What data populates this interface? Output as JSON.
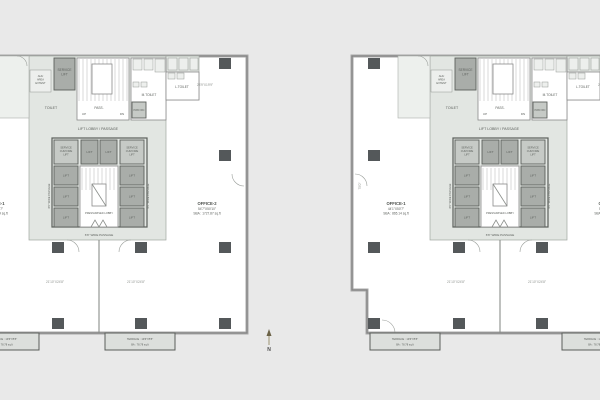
{
  "colors": {
    "background": "#e9e9e9",
    "plan_interior": "#ffffff",
    "core_fill": "#e2e6e2",
    "lift_fill": "#a9ada9",
    "column_fill": "#54585a",
    "terrace_fill": "#dcdfdc"
  },
  "labels": {
    "service_lift_l1": "SERVICE",
    "service_lift_l2": "LIFT",
    "ahu_l1": "AHU",
    "ahu_l2": "AREA",
    "ahu_l3": "EXTENT",
    "toilet": "TOILET",
    "pass": "PASS.",
    "up": "UP",
    "dn": "DN",
    "m_toilet": "M.TOILET",
    "l_toilet": "L.TOILET",
    "pwd": "PWD WC",
    "lift_lobby": "LIFT LOBBY / PASSAGE",
    "lift": "LIFT",
    "sfl_l1": "SERVICE",
    "sfl_l2": "CUM FIRE",
    "sfl_l3": "LIFT",
    "pressurized_lobby": "PRESSURISED LOBBY",
    "wide_passage": "6'6\" WIDE PASSAGE",
    "side_passage": "6'0\" WIDE PASSAGE",
    "north": "N"
  },
  "plans": {
    "left": {
      "office_left": {
        "title": "OFFICE-1",
        "dims": "44'1\"X50'7\"",
        "area": "SBA : 865.14 sq.ft"
      },
      "office_right": {
        "title": "OFFICE-2",
        "dims": "54'7\"X50'10\"",
        "area": "SBA : 1727.87 sq.ft"
      },
      "side_dim": "75'0\"",
      "corner_dim": "23'9\"X19'9\"",
      "room_dim_left": "21'10\"X24'8\"",
      "room_dim_right": "21'10\"X24'8\"",
      "terrace1": {
        "l1": "TERRACE : 19'6\"X5'5\"",
        "l2": "BA : 78.78 sq.ft"
      },
      "terrace2": {
        "l1": "TERRACE : 19'6\"X5'5\"",
        "l2": "BA : 78.78 sq.ft"
      }
    },
    "right": {
      "office_left": {
        "title": "OFFICE-1",
        "dims": "44'1\"X50'7\"",
        "area": "SBA : 865.14 sq.ft"
      },
      "office_right": {
        "title": "OFFICE-2",
        "dims": "54'7\"X50'10\"",
        "area": "SBA : 1727.87 sq.ft"
      },
      "side_dim": "75'0\"",
      "corner_dim": "23'9\"X19'9\"",
      "room_dim_left": "21'10\"X24'8\"",
      "room_dim_right": "21'10\"X24'8\"",
      "terrace1": {
        "l1": "TERRACE : 19'6\"X5'5\"",
        "l2": "BA : 78.78 sq.ft"
      },
      "terrace2": {
        "l1": "TERRACE : 19'6\"X5'5\"",
        "l2": "BA : 78.78 sq.ft"
      }
    }
  }
}
